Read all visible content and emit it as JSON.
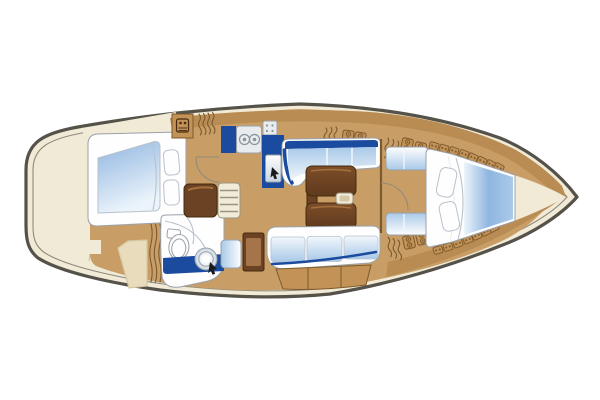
{
  "figure": {
    "title": "Sailing yacht interior layout plan, top view, bow pointing right",
    "type": "yacht-deck-plan",
    "orientation": "bow-right"
  },
  "areas": [
    {
      "id": "aft-cabin",
      "desc": "double berth with two pillows"
    },
    {
      "id": "head-compartment",
      "desc": "toilet, round washbasin on navy counter, shower"
    },
    {
      "id": "companionway",
      "desc": "entry steps and engine box"
    },
    {
      "id": "galley",
      "desc": "L-shaped navy counter with two-burner stove and sink"
    },
    {
      "id": "salon",
      "desc": "U-shaped settee, folding table, straight settee"
    },
    {
      "id": "nav-station",
      "desc": "chart desk with seat"
    },
    {
      "id": "forward-cabin",
      "desc": "V-berth with two pillows"
    },
    {
      "id": "bow-locker",
      "desc": "anchor locker wedge"
    }
  ],
  "colors": {
    "bg": "#ffffff",
    "cream": "#f1ead6",
    "cream_line": "#d5c8a4",
    "hull_outline": "#55524a",
    "inner_line": "#8f8b7c",
    "wood": "#c89e66",
    "wood_band": "#b88c52",
    "wood_line": "#7c5a2e",
    "wood_locker": "#c29256",
    "locker_face": "#e8dcbc",
    "navy": "#1b4b9e",
    "cushion_deep": "#a9c9e8",
    "cushion_pale": "#f2f7fc",
    "berth_deep": "#8fb6e0",
    "berth_pale": "#ecf4fb",
    "white": "#fefefe",
    "white_warm": "#f1ecda",
    "steps_line": "#9a947e",
    "outline_gray": "#9aa1a8",
    "line_soft": "#b9c2cc",
    "sink_steel": "#c9d6e2",
    "table_dark": "#5f3a1c",
    "table_mid": "#7d4e2a",
    "table_hi": "#a4713d",
    "dark_wood": "#6b4223",
    "dark_wood_line": "#46290e",
    "desk_panel": "#a5744a",
    "steel": "#e8ecef",
    "burner_line": "#8a949c",
    "black": "#1a1a1a"
  },
  "decor": {
    "cubbies": [
      [
        434,
        146,
        16
      ],
      [
        444,
        148.5,
        18
      ],
      [
        454,
        151,
        20
      ],
      [
        464,
        154,
        22
      ],
      [
        473,
        157.5,
        24
      ],
      [
        482,
        161,
        26
      ],
      [
        491,
        164.5,
        28
      ],
      [
        499,
        167.5,
        30
      ],
      [
        438,
        250,
        -16
      ],
      [
        448,
        247,
        -18
      ],
      [
        458,
        243.5,
        -20
      ],
      [
        468,
        239.5,
        -22
      ],
      [
        477,
        235.5,
        -24
      ],
      [
        486,
        231.5,
        -26
      ],
      [
        494,
        227.5,
        -28
      ]
    ],
    "latches": [
      [
        348,
        137,
        7
      ],
      [
        360,
        139,
        9
      ],
      [
        407,
        145,
        12
      ],
      [
        420,
        149,
        14
      ],
      [
        409,
        242,
        -12
      ],
      [
        422,
        238,
        -14
      ]
    ],
    "vents": [
      [
        388,
        138,
        10,
        20
      ],
      [
        393,
        139.5,
        10,
        20
      ],
      [
        398,
        141,
        10,
        20
      ],
      [
        326,
        128,
        5,
        17
      ],
      [
        331,
        127.5,
        5,
        17
      ],
      [
        336,
        127,
        5,
        17
      ],
      [
        388,
        237,
        -8,
        20
      ],
      [
        393,
        238.5,
        -8,
        20
      ],
      [
        398,
        240,
        -8,
        20
      ],
      [
        151,
        224,
        0,
        58
      ],
      [
        155.5,
        224,
        0,
        58
      ],
      [
        160,
        224,
        0,
        58
      ],
      [
        199,
        114,
        -4,
        21
      ],
      [
        203.5,
        113.5,
        -4,
        21
      ],
      [
        208,
        113,
        -4,
        21
      ],
      [
        212.5,
        112.5,
        -4,
        21
      ]
    ]
  }
}
